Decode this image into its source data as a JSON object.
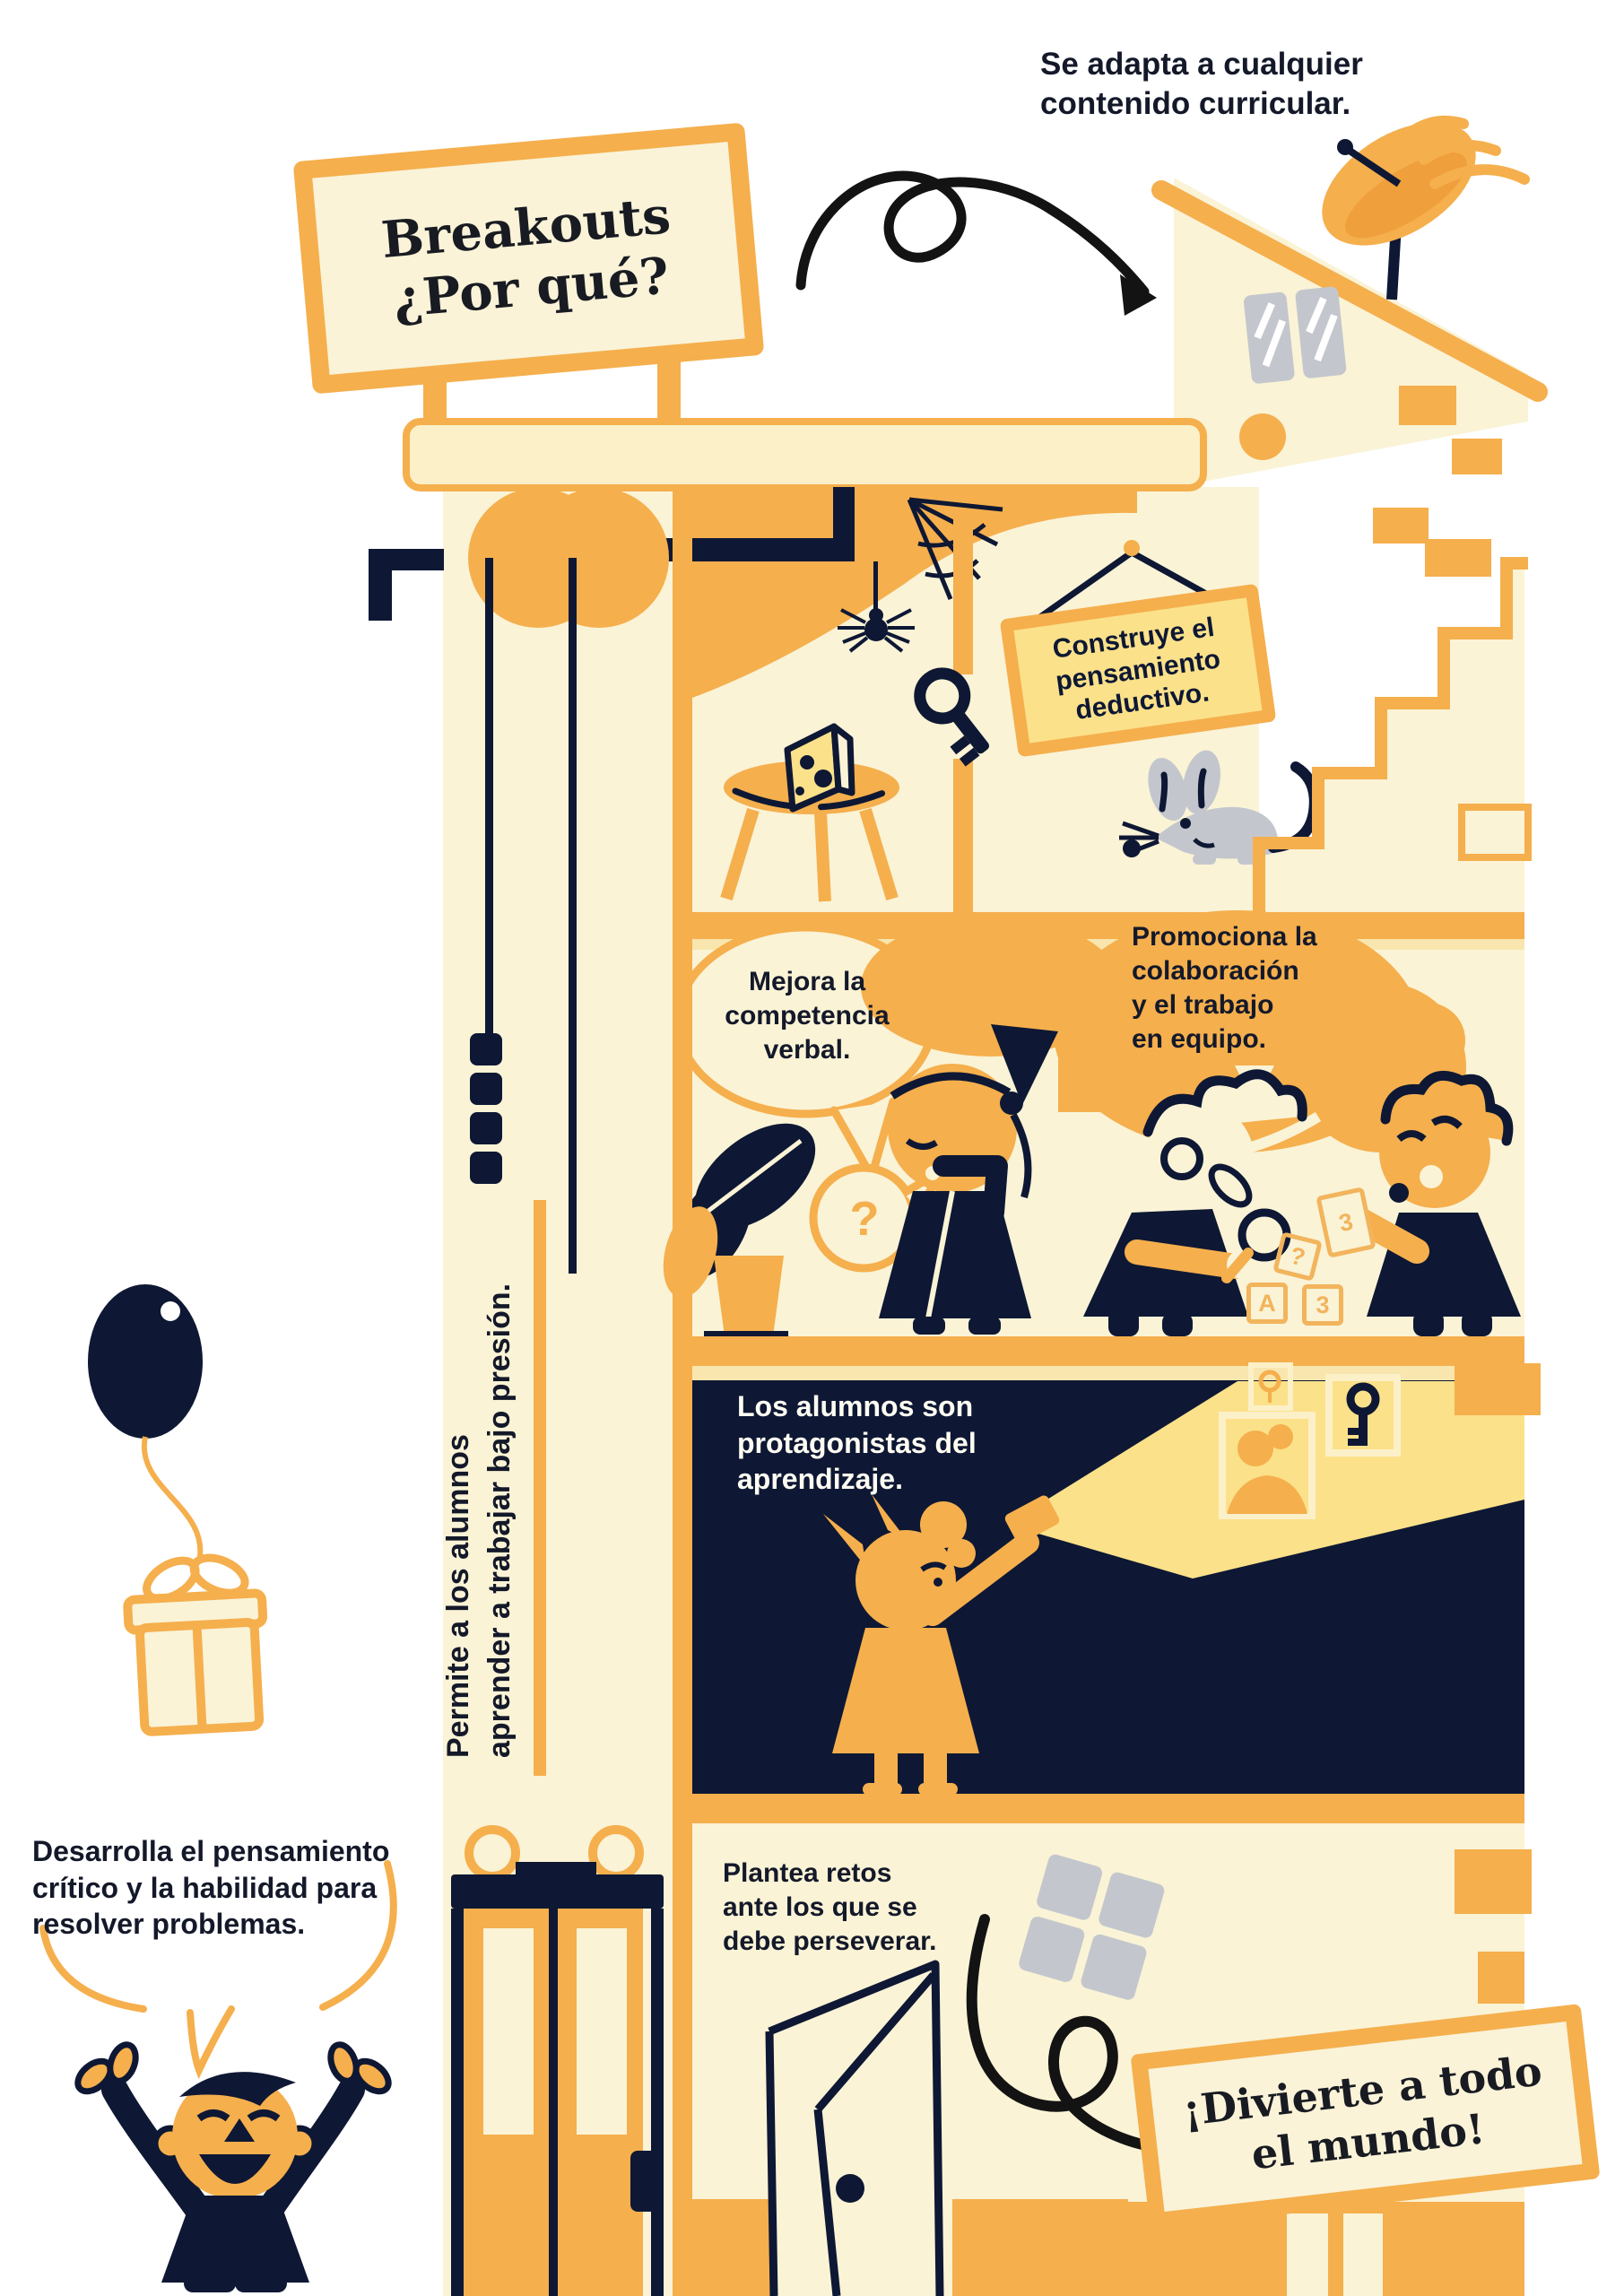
{
  "palette": {
    "cream": "#FAF3D6",
    "pale_yellow": "#FBF0C8",
    "sign_yellow": "#FBE18A",
    "orange": "#F5AF4D",
    "navy": "#0E1834",
    "grey": "#C3C7CD",
    "doodle_black": "#131313",
    "text_dark": "#14192a",
    "text_light": "#FFFDF2",
    "block_orange": "#F2B45C"
  },
  "signs": {
    "main": {
      "lines": [
        "Breakouts",
        "¿Por qué?"
      ]
    },
    "hanging": {
      "lines": [
        "Construye el",
        "pensamiento",
        "deductivo."
      ]
    },
    "bottom": {
      "lines": [
        "¡Divierte a todo",
        "el mundo!"
      ]
    }
  },
  "notes": {
    "adapta": {
      "lines": [
        "Se adapta a cualquier",
        "contenido curricular."
      ]
    },
    "promociona": {
      "lines": [
        "Promociona la",
        "colaboración",
        "y el trabajo",
        "en equipo."
      ]
    },
    "mejora": {
      "lines": [
        "Mejora la",
        "competencia",
        "verbal."
      ]
    },
    "permite": {
      "lines": [
        "Permite a los alumnos",
        "aprender a trabajar bajo presión."
      ]
    },
    "alumnos": {
      "lines": [
        "Los alumnos son",
        "protagonistas del",
        "aprendizaje."
      ]
    },
    "desarrolla": {
      "lines": [
        "Desarrolla el pensamiento",
        "crítico y la habilidad para",
        "resolver problemas."
      ]
    },
    "plantea": {
      "lines": [
        "Plantea retos",
        "ante los que se",
        "debe perseverar."
      ]
    }
  },
  "props": {
    "question_bubble": "?",
    "block_a": "A",
    "block_q": "?",
    "block_3": "3",
    "card_3": "3"
  }
}
